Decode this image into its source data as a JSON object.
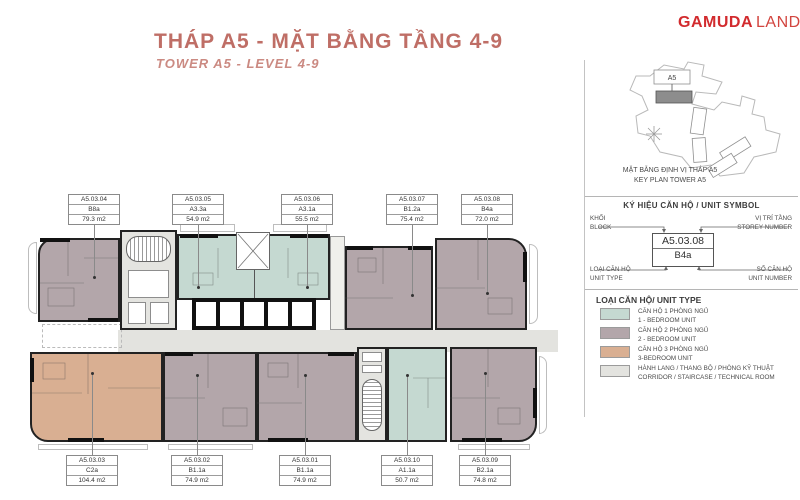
{
  "header": {
    "title_vi": "THÁP A5 - MẶT BẰNG TẦNG 4-9",
    "title_en": "TOWER A5 - LEVEL 4-9",
    "brand_bold": "GAMUDA",
    "brand_light": "LAND"
  },
  "key_plan": {
    "caption_vi": "MẶT BẰNG ĐỊNH VỊ THÁP A5",
    "caption_en": "KEY PLAN TOWER A5",
    "highlight_label": "A5"
  },
  "unit_symbol": {
    "heading": "KÝ HIỆU CĂN HỘ / UNIT SYMBOL",
    "example_code": "A5.03.08",
    "example_type": "B4a",
    "block_vi": "KHỐI",
    "block_en": "BLOCK",
    "storey_vi": "VỊ TRÍ TẦNG",
    "storey_en": "STOREY NUMBER",
    "unit_type_vi": "LOẠI CĂN HỘ",
    "unit_type_en": "UNIT TYPE",
    "unit_number_vi": "SỐ CĂN HỘ",
    "unit_number_en": "UNIT NUMBER"
  },
  "unit_types": {
    "heading": "LOẠI CĂN HỘ/ UNIT TYPE",
    "items": [
      {
        "color": "#c5d9d1",
        "label_vi": "CĂN HỘ 1 PHÒNG NGỦ",
        "label_en": "1 - BEDROOM UNIT"
      },
      {
        "color": "#b3a6aa",
        "label_vi": "CĂN HỘ 2 PHÒNG NGỦ",
        "label_en": "2 - BEDROOM UNIT"
      },
      {
        "color": "#d9af92",
        "label_vi": "CĂN HỘ 3 PHÒNG NGỦ",
        "label_en": "3-BEDROOM UNIT"
      },
      {
        "color": "#e3e3df",
        "label_vi": "HÀNH LANG / THANG BỘ / PHÒNG KỸ THUẬT",
        "label_en": "CORRIDOR / STAIRCASE / TECHNICAL ROOM"
      }
    ]
  },
  "units": {
    "top": [
      {
        "code": "A5.03.04",
        "type": "B8a",
        "area": "79.3 m2"
      },
      {
        "code": "A5.03.05",
        "type": "A3.3a",
        "area": "54.9 m2"
      },
      {
        "code": "A5.03.06",
        "type": "A3.1a",
        "area": "55.5 m2"
      },
      {
        "code": "A5.03.07",
        "type": "B1.2a",
        "area": "75.4 m2"
      },
      {
        "code": "A5.03.08",
        "type": "B4a",
        "area": "72.0 m2"
      }
    ],
    "bottom": [
      {
        "code": "A5.03.03",
        "type": "C2a",
        "area": "104.4 m2"
      },
      {
        "code": "A5.03.02",
        "type": "B1.1a",
        "area": "74.9 m2"
      },
      {
        "code": "A5.03.01",
        "type": "B1.1a",
        "area": "74.9 m2"
      },
      {
        "code": "A5.03.10",
        "type": "A1.1a",
        "area": "50.7 m2"
      },
      {
        "code": "A5.03.09",
        "type": "B2.1a",
        "area": "74.8 m2"
      }
    ]
  }
}
